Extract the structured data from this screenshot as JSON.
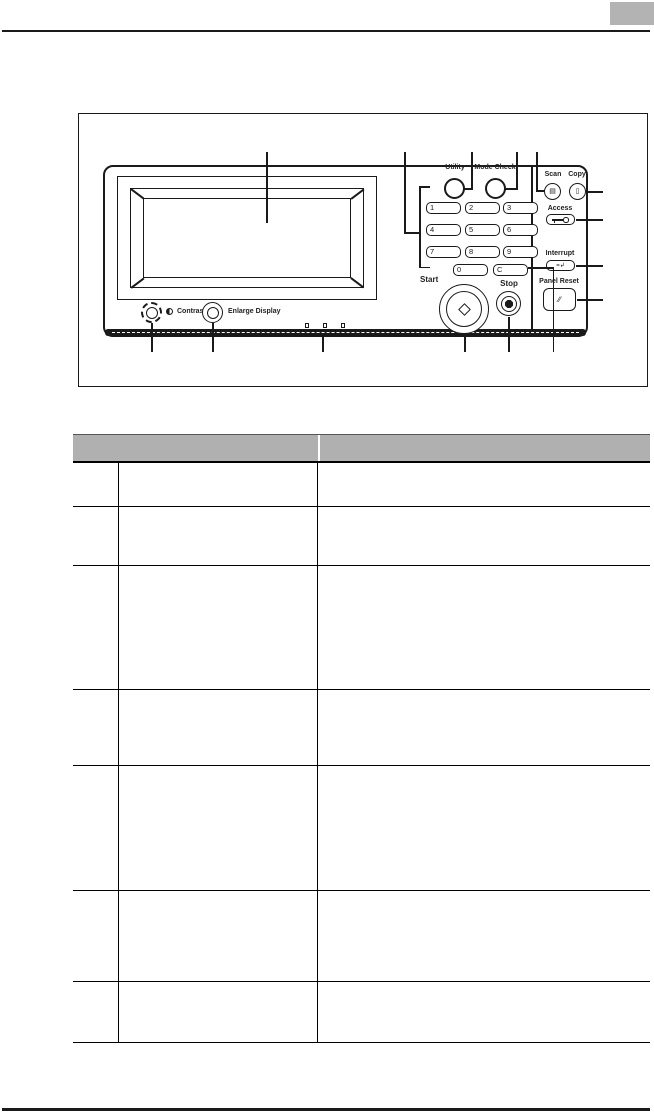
{
  "page": {
    "background": "#ffffff",
    "line_color": "#1a1a1a",
    "corner_tab_color": "#b3b3b3",
    "table_header_color": "#b0b0b0"
  },
  "diagram": {
    "description": "control panel illustration with callout lines",
    "panel": {
      "buttons": {
        "utility": "Utility",
        "mode_check": "Mode Check",
        "scan": "Scan",
        "copy": "Copy",
        "access": "Access",
        "interrupt": "Interrupt",
        "panel_reset": "Panel Reset",
        "start": "Start",
        "stop": "Stop",
        "contrast": "Contrast",
        "enlarge_display": "Enlarge Display"
      },
      "keypad": [
        "1",
        "2",
        "3",
        "4",
        "5",
        "6",
        "7",
        "8",
        "9",
        "0",
        "C"
      ],
      "icons": {
        "scan_icon": "▤",
        "copy_icon": "▯",
        "interrupt_icon": "=↲",
        "panel_reset_icon": "∕∕"
      }
    }
  },
  "table": {
    "columns": [
      "",
      "",
      ""
    ],
    "rows": [
      [
        "",
        "",
        ""
      ],
      [
        "",
        "",
        ""
      ],
      [
        "",
        "",
        ""
      ],
      [
        "",
        "",
        ""
      ],
      [
        "",
        "",
        ""
      ],
      [
        "",
        "",
        ""
      ],
      [
        "",
        "",
        ""
      ]
    ]
  }
}
